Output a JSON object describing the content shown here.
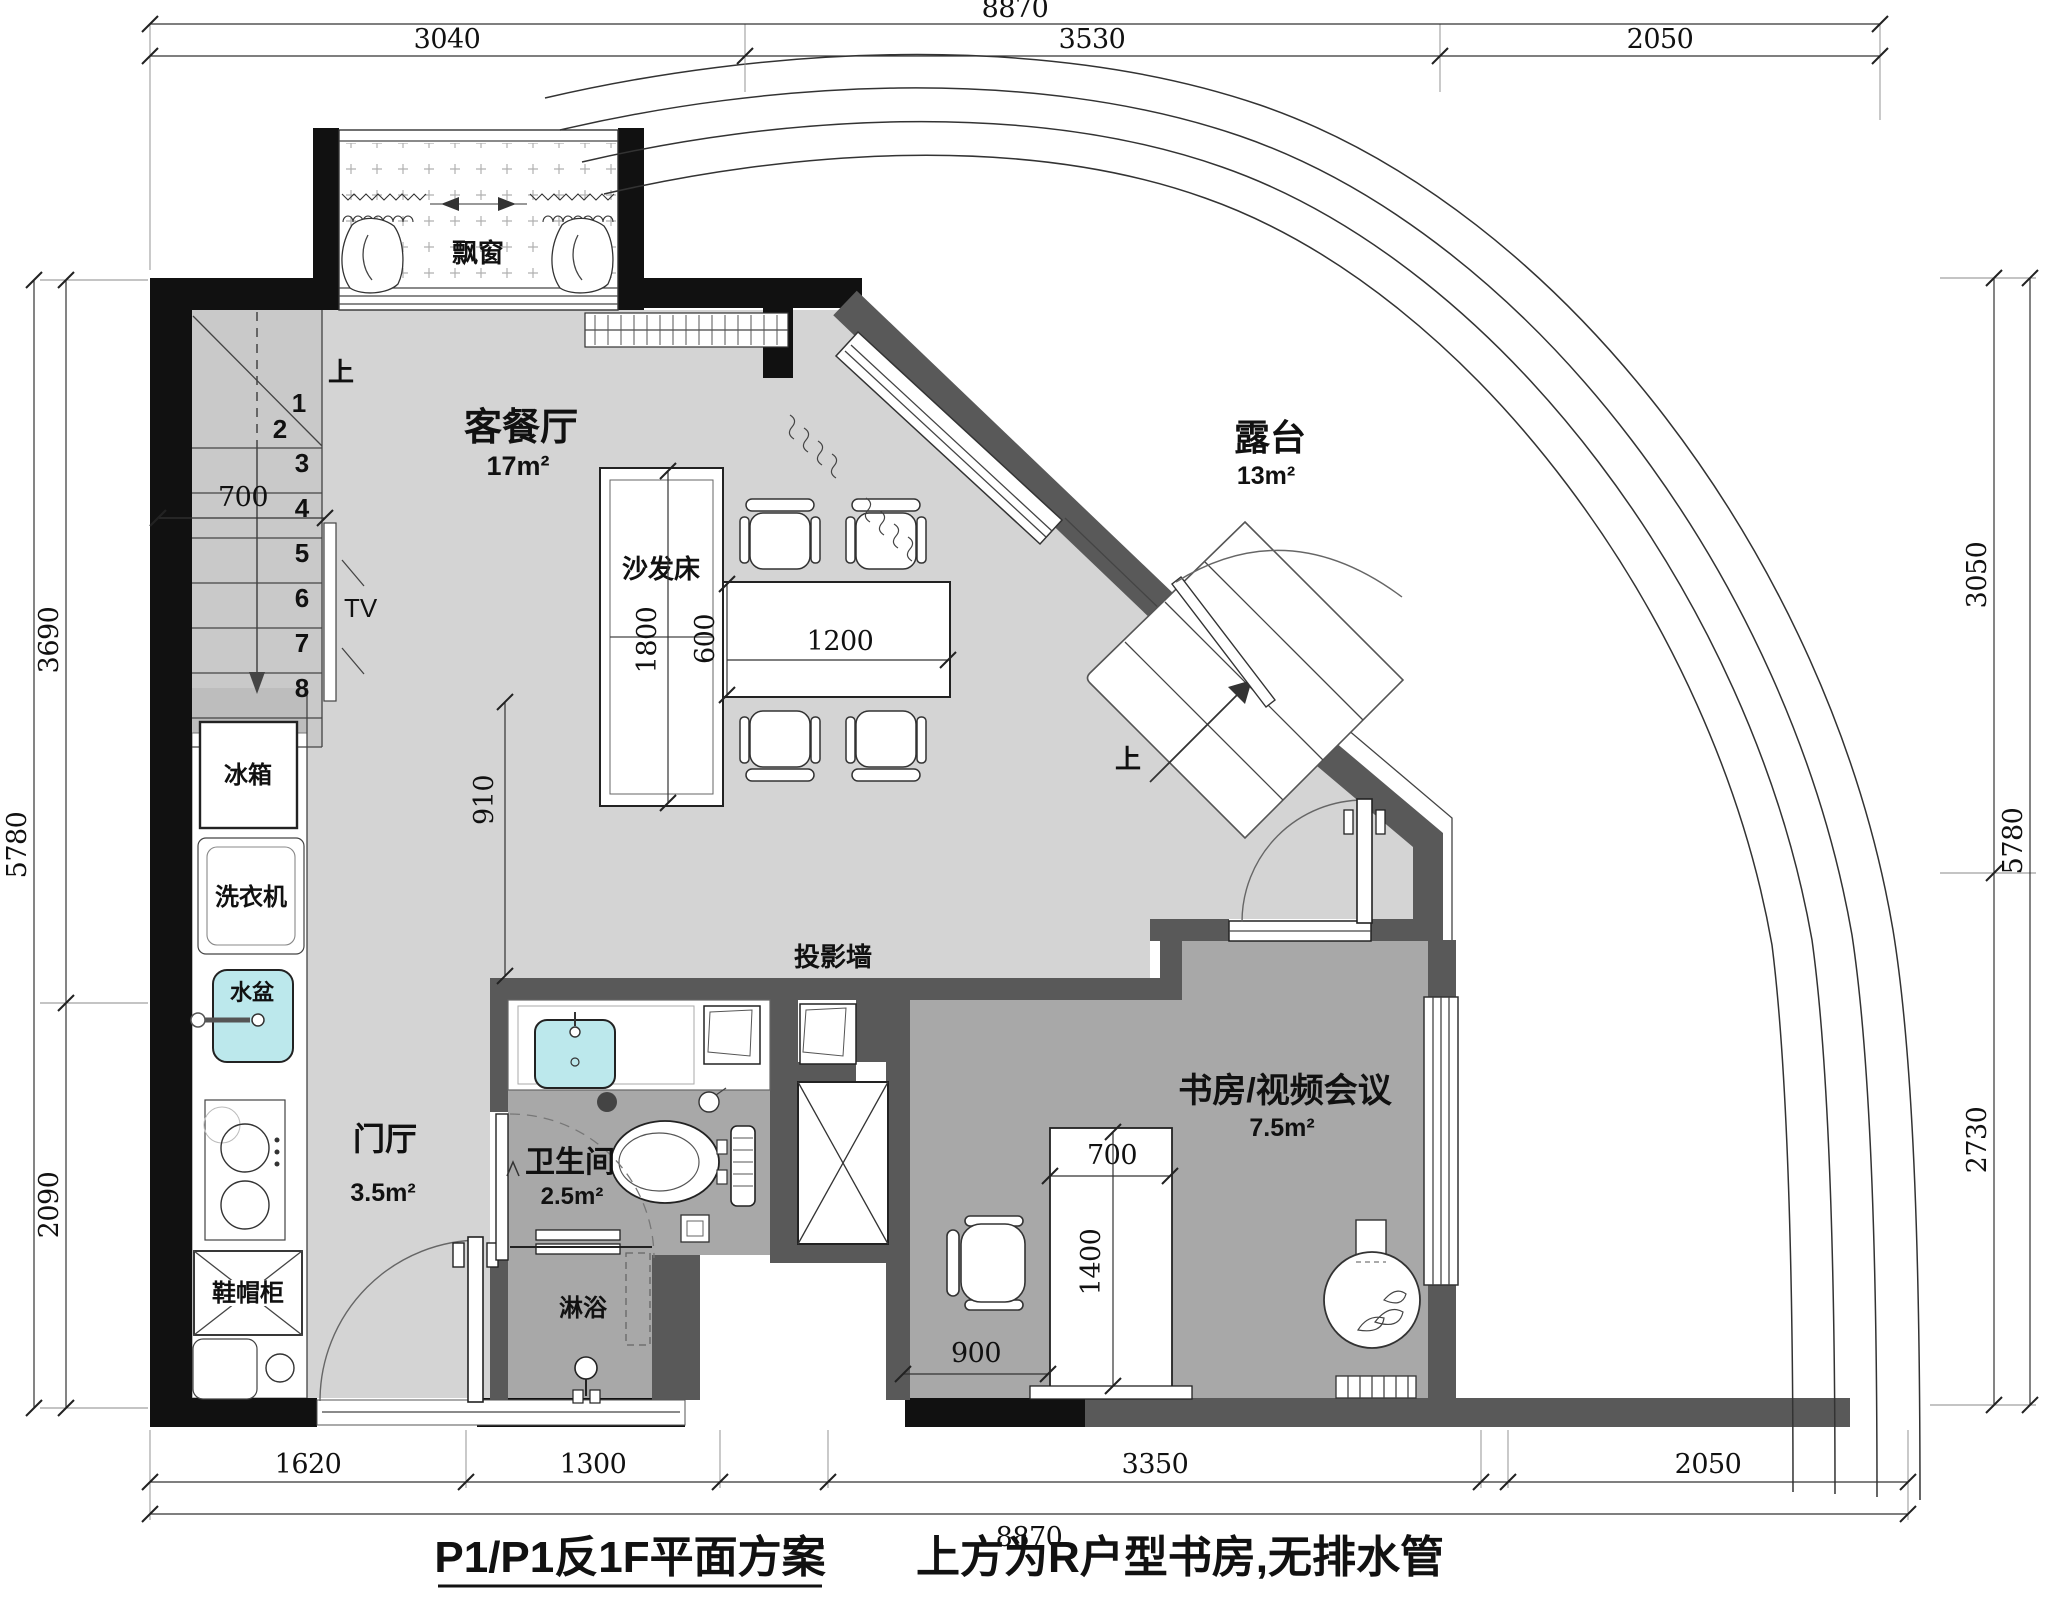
{
  "title": {
    "main": "P1/P1反1F平面方案",
    "note": "上方为R户型书房,无排水管"
  },
  "rooms": {
    "living": {
      "name": "客餐厅",
      "area": "17m²"
    },
    "terrace": {
      "name": "露台",
      "area": "13m²"
    },
    "hall": {
      "name": "门厅",
      "area": "3.5m²"
    },
    "bath": {
      "name": "卫生间",
      "area": "2.5m²"
    },
    "study": {
      "name": "书房/视频会议",
      "area": "7.5m²"
    }
  },
  "labels": {
    "bay_window": "飘窗",
    "sofa_bed": "沙发床",
    "tv": "TV",
    "fridge": "冰箱",
    "washer": "洗衣机",
    "basin": "水盆",
    "shoe_cabinet": "鞋帽柜",
    "projection_wall": "投影墙",
    "shower": "淋浴",
    "up_stairs": "上",
    "up_terrace": "上"
  },
  "stairs": {
    "steps": [
      "1",
      "2",
      "3",
      "4",
      "5",
      "6",
      "7",
      "8"
    ]
  },
  "dimensions": {
    "top": {
      "total": "8870",
      "segments": [
        "3040",
        "3530",
        "2050"
      ]
    },
    "bottom": {
      "total": "8870",
      "segments": [
        "1620",
        "1300",
        "3350",
        "2050"
      ]
    },
    "left": {
      "total": "5780",
      "segments": [
        "3690",
        "2090"
      ]
    },
    "right": {
      "total": "5780",
      "segments": [
        "3050",
        "2730"
      ]
    },
    "inner": {
      "stair_width": "700",
      "sofa_length": "1800",
      "table_depth": "600",
      "table_width": "1200",
      "passage": "910",
      "desk_width": "700",
      "desk_length": "1400",
      "desk_offset": "900"
    }
  },
  "colors": {
    "wall_black": "#111111",
    "wall_gray": "#595959",
    "floor_light": "#d4d4d4",
    "floor_mid": "#a8a8a8",
    "stair_gray": "#c9c9c9",
    "sink_cyan": "#bce8ec"
  }
}
